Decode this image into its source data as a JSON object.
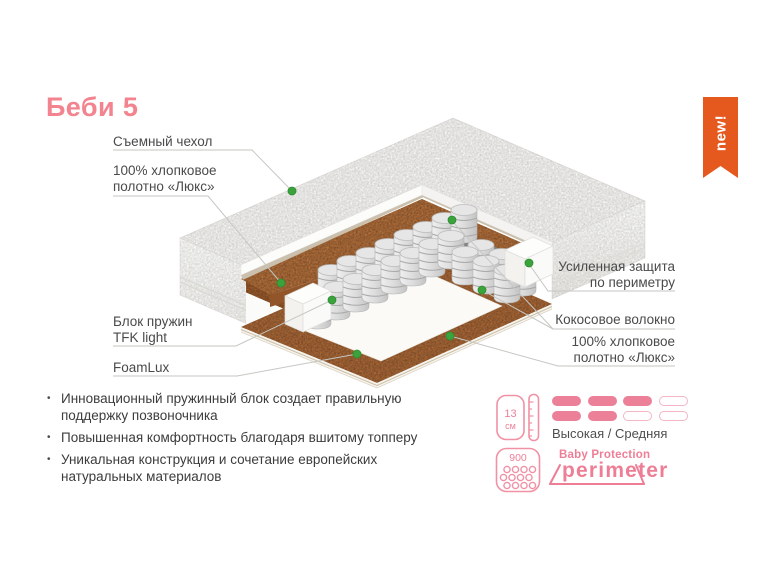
{
  "title": "Беби 5",
  "badge": {
    "label": "new!"
  },
  "callouts": {
    "cover": {
      "lines": [
        "Съемный чехол"
      ]
    },
    "cotton_top": {
      "lines": [
        "100% хлопковое",
        "полотно «Люкс»"
      ]
    },
    "spring_block": {
      "lines": [
        "Блок пружин",
        "TFK light"
      ]
    },
    "foamlux": {
      "lines": [
        "FoamLux"
      ]
    },
    "perimeter": {
      "lines": [
        "Усиленная защита",
        "по периметру"
      ]
    },
    "coconut": {
      "lines": [
        "Кокосовое волокно"
      ]
    },
    "cotton_bottom": {
      "lines": [
        "100% хлопковое",
        "полотно «Люкс»"
      ]
    }
  },
  "features": [
    "Инновационный пружинный блок создает правильную поддержку позвоночника",
    "Повышенная комфортность благодаря вшитому топперу",
    "Уникальная конструкция и сочетание европейских натуральных материалов"
  ],
  "specs": {
    "height": {
      "value": "13",
      "unit": "см",
      "icon": "mattress-height-icon"
    },
    "firmness": {
      "label": "Высокая / Средняя",
      "pattern": [
        [
          1,
          1,
          1,
          0
        ],
        [
          1,
          1,
          0,
          0
        ]
      ]
    },
    "springs": {
      "count": "900",
      "icon": "springs-count-icon"
    },
    "brand": {
      "line1": "Baby Protection",
      "line2": "perimeter"
    }
  },
  "colors": {
    "accent_pink": "#ee7e96",
    "title_pink": "#f2838f",
    "badge_orange": "#e5591f",
    "dot_green": "#3aa33b",
    "coir_brown": "#b5713c",
    "label_gray": "#4a4a4a"
  }
}
